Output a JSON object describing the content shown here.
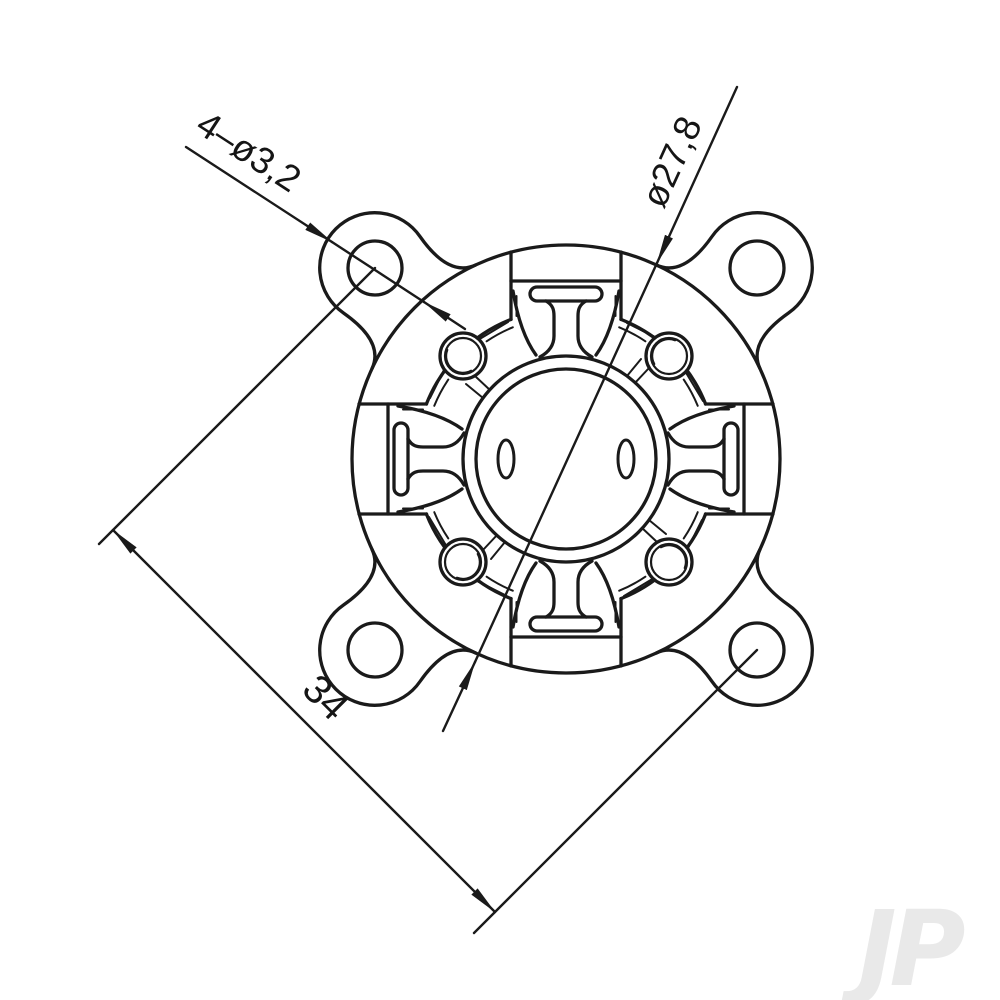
{
  "drawing": {
    "dim_holes_label": "4–ø3,2",
    "dim_diameter_label": "ø27,8",
    "dim_spacing_label": "34",
    "watermark": "JP",
    "colors": {
      "line": "#1a1a1a",
      "background": "#ffffff",
      "watermark": "#e9e9e9"
    }
  }
}
